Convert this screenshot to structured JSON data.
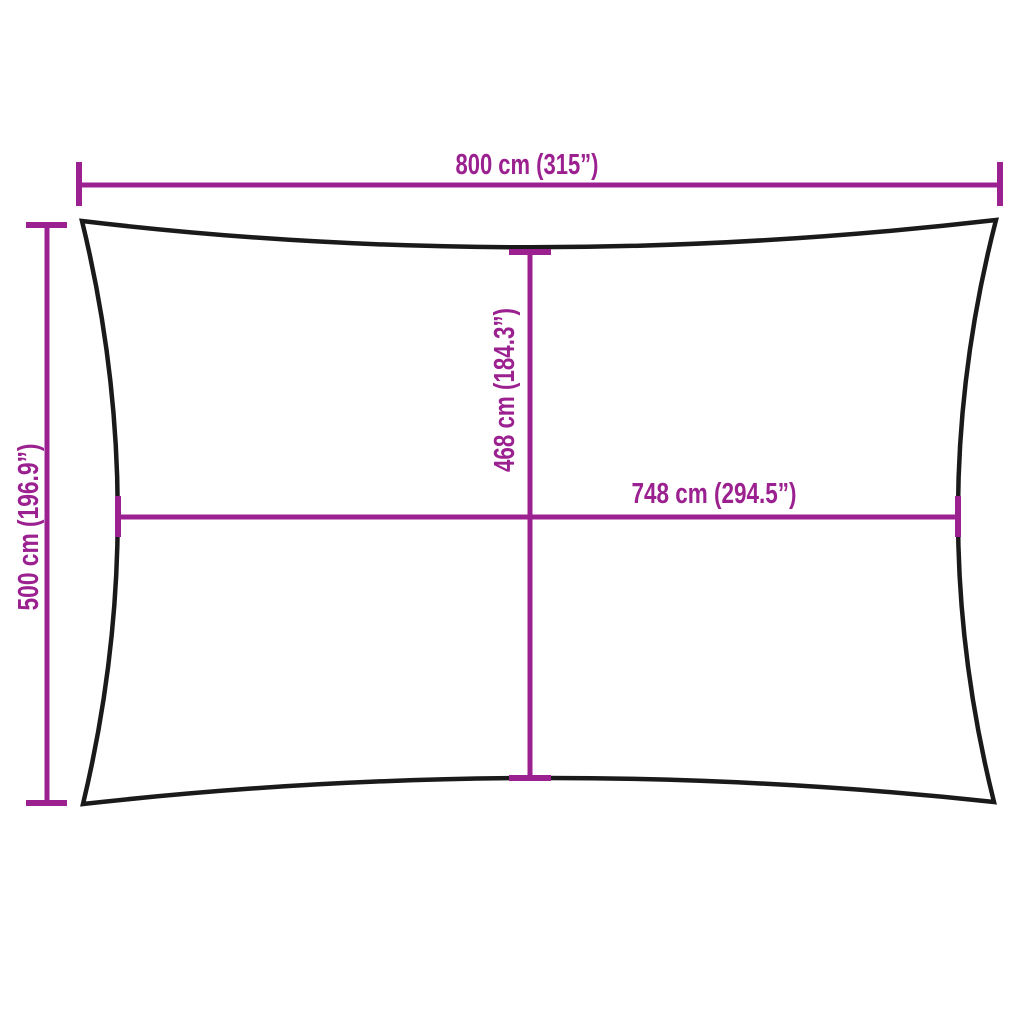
{
  "diagram": {
    "type": "product-dimension-diagram",
    "subject": "rectangular shade sail outline with concave edges",
    "labels": {
      "outer_width": "800 cm (315”)",
      "outer_height": "500 cm (196.9”)",
      "inner_height": "468 cm (184.3”)",
      "inner_width": "748 cm (294.5”)"
    },
    "measurements": {
      "outer_width_cm": 800,
      "outer_width_inches": 315,
      "outer_height_cm": 500,
      "outer_height_inches": 196.9,
      "inner_height_cm": 468,
      "inner_height_inches": 184.3,
      "inner_width_cm": 748,
      "inner_width_inches": 294.5
    },
    "colors": {
      "dimension_magenta": "#9C2190",
      "outline_black": "#1A1A1A",
      "background": "#FFFFFF"
    }
  }
}
